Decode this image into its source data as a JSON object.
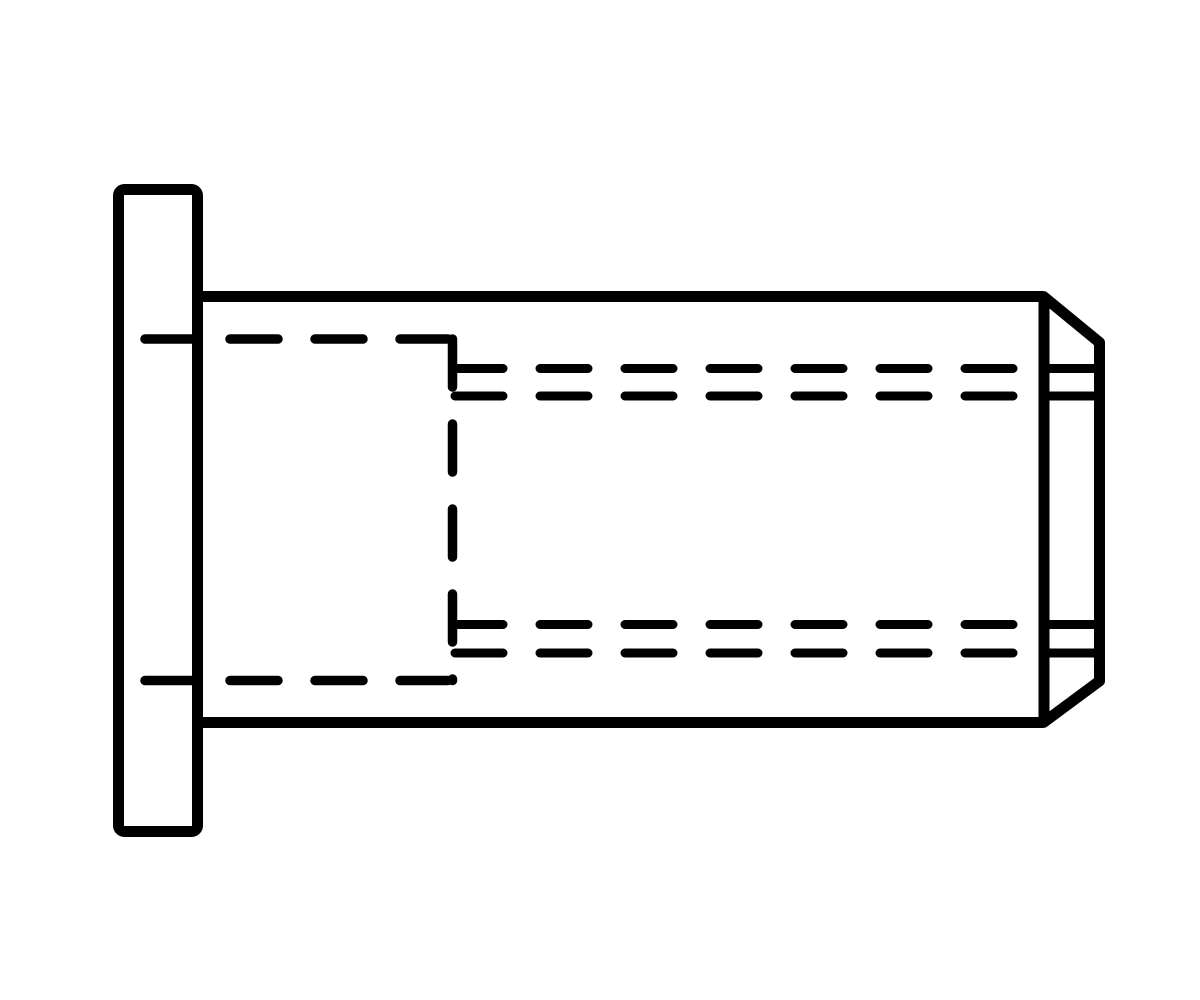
{
  "page": {
    "width": 1200,
    "height": 1000,
    "background_color": "#ffffff",
    "ink_color": "#000000"
  },
  "drawing": {
    "kind": "engineering-line-drawing",
    "subject": "blind-rivet-nut-flat-head-side-view",
    "viewbox": "0 0 1200 1000",
    "line_styles": {
      "visible_outline_width": 11,
      "hidden_line_width": 9.5,
      "detail_line_width": 9,
      "hidden_dash_pattern": "48 37"
    },
    "elements": [
      {
        "name": "flange-head-outline",
        "shape": "rect",
        "x": 118.5,
        "y": 189.5,
        "width": 79,
        "height": 642,
        "rx": 6,
        "stroke_width": 11,
        "style": "solid"
      },
      {
        "name": "body-outline",
        "shape": "path",
        "d": "M 197 296.5 L 1043.5 296.5 L 1099.5 342.5 L 1099.5 681 L 1043.5 722.5 L 197 722.5",
        "stroke_width": 11,
        "style": "solid"
      },
      {
        "name": "chamfer-start-line",
        "shape": "line",
        "x1": 1044,
        "y1": 296.5,
        "x2": 1044,
        "y2": 722.5,
        "stroke_width": 11,
        "style": "solid"
      },
      {
        "name": "thread-relief-top-outer",
        "shape": "line",
        "x1": 1044,
        "y1": 368.5,
        "x2": 1099,
        "y2": 368.5,
        "stroke_width": 9,
        "style": "solid"
      },
      {
        "name": "thread-relief-top-inner",
        "shape": "line",
        "x1": 1044,
        "y1": 396,
        "x2": 1099,
        "y2": 396,
        "stroke_width": 9,
        "style": "solid"
      },
      {
        "name": "thread-relief-bottom-inner",
        "shape": "line",
        "x1": 1044,
        "y1": 624.5,
        "x2": 1099,
        "y2": 624.5,
        "stroke_width": 9,
        "style": "solid"
      },
      {
        "name": "thread-relief-bottom-outer",
        "shape": "line",
        "x1": 1044,
        "y1": 653,
        "x2": 1099,
        "y2": 653,
        "stroke_width": 9,
        "style": "solid"
      },
      {
        "name": "hidden-bore-top-line",
        "shape": "line",
        "x1": 145,
        "y1": 339,
        "x2": 453,
        "y2": 339,
        "stroke_width": 9.5,
        "style": "dashed",
        "dash": "48 37"
      },
      {
        "name": "hidden-bore-bottom-line",
        "shape": "line",
        "x1": 145,
        "y1": 680.5,
        "x2": 453,
        "y2": 680.5,
        "stroke_width": 9.5,
        "style": "dashed",
        "dash": "48 37"
      },
      {
        "name": "hidden-bore-end-line",
        "shape": "line",
        "x1": 452.5,
        "y1": 339,
        "x2": 452.5,
        "y2": 680.5,
        "stroke_width": 9.5,
        "style": "dashed",
        "dash": "48 37"
      },
      {
        "name": "hidden-thread-top-outer",
        "shape": "line",
        "x1": 455,
        "y1": 368.5,
        "x2": 1018,
        "y2": 368.5,
        "stroke_width": 9,
        "style": "dashed",
        "dash": "48 37"
      },
      {
        "name": "hidden-thread-top-inner",
        "shape": "line",
        "x1": 455,
        "y1": 396,
        "x2": 1018,
        "y2": 396,
        "stroke_width": 9,
        "style": "dashed",
        "dash": "48 37"
      },
      {
        "name": "hidden-thread-bottom-inner",
        "shape": "line",
        "x1": 455,
        "y1": 624.5,
        "x2": 1018,
        "y2": 624.5,
        "stroke_width": 9,
        "style": "dashed",
        "dash": "48 37"
      },
      {
        "name": "hidden-thread-bottom-outer",
        "shape": "line",
        "x1": 455,
        "y1": 653,
        "x2": 1018,
        "y2": 653,
        "stroke_width": 9,
        "style": "dashed",
        "dash": "48 37"
      }
    ]
  }
}
